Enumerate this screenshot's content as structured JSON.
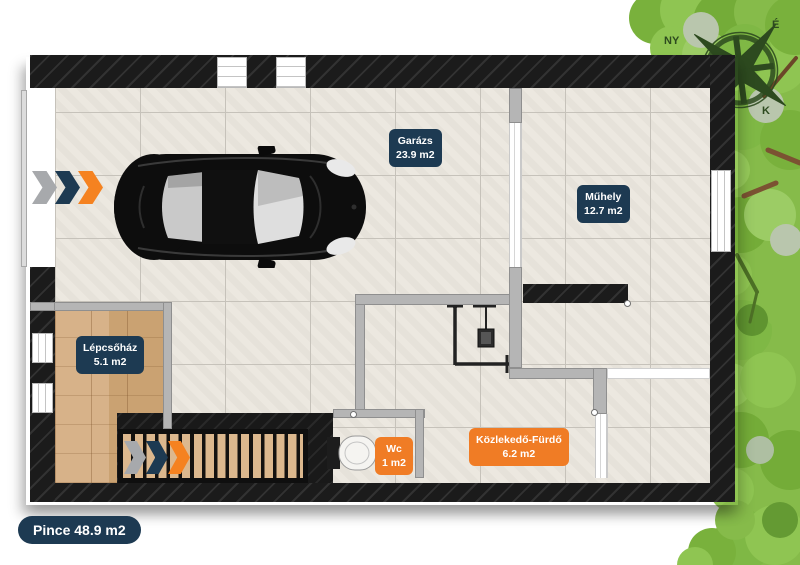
{
  "floor_plan": {
    "badge": "Pince 48.9 m2",
    "rooms": {
      "garazs": {
        "name": "Garázs",
        "area": "23.9 m2"
      },
      "muhely": {
        "name": "Műhely",
        "area": "12.7 m2"
      },
      "lepcsohaz": {
        "name": "Lépcsőház",
        "area": "5.1 m2"
      },
      "wc": {
        "name": "Wc",
        "area": "1 m2"
      },
      "kozlekedo_furdo": {
        "name": "Közlekedő-Fürdő",
        "area": "6.2 m2"
      }
    },
    "compass": {
      "north": "É",
      "west": "NY",
      "east": "K"
    },
    "colors": {
      "label_navy": "#1d3a52",
      "label_orange": "#f07c25",
      "wall_black": "#1b1b1b",
      "tile_floor": "#ece8e0",
      "wood_floor": "#d2ab7e",
      "tree_green": "#86bb4a",
      "arrow_gray": "#a7a9ac",
      "arrow_navy": "#1d3a52",
      "arrow_orange": "#f58220"
    }
  }
}
